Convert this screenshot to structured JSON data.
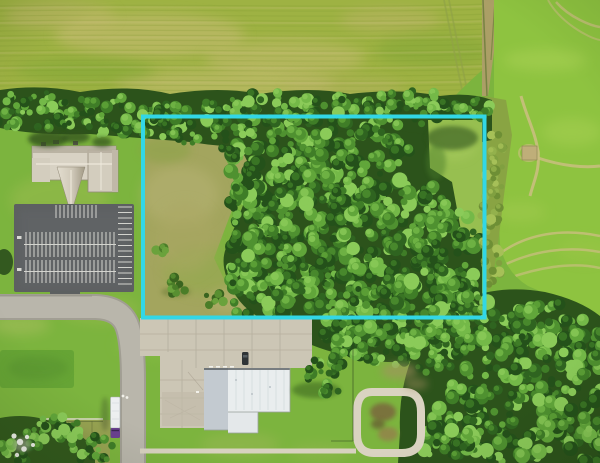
{
  "photo": {
    "type": "aerial-drone-photograph",
    "alt": "Aerial view of a wooded vacant land parcel outlined with a cyan boundary, next to a church with parking lot, crop fields, a street intersection, a white metal-roof building, a loop driveway and a semi truck",
    "width_px": 600,
    "height_px": 463
  },
  "boundary_overlay": {
    "shape": "rectangle",
    "color": "#32d7e6",
    "x": 143,
    "y": 116.5,
    "width": 341.5,
    "height": 201,
    "stroke_width": 4
  },
  "palette": {
    "crop_field_yellow_green": "#9eb243",
    "crop_field_bright_green": "#8ec340",
    "tractor_track_tan": "#cdbe83",
    "woods_dark_green": "#2c531b",
    "woods_light_green": "#74b948",
    "meadow_olive": "#a3a55e",
    "lawn_green": "#7cb43e",
    "asphalt_gray": "#5d6061",
    "street_gray": "#b9b6ab",
    "concrete_tan": "#ccc6b5",
    "metal_roof_white": "#e9edee",
    "church_roof_tan": "#d8d2c4",
    "truck_cab_purple": "#6a4190"
  },
  "visible_features": [
    "cyan rectangular property boundary overlay",
    "dense wooded parcel inside boundary",
    "open olive meadow inside west part of boundary",
    "grass clearing inside northeast corner of boundary",
    "hedgerow tree line along north field edge",
    "yellow-green crop field top left",
    "bright green crop field with curved tractor tracks on right",
    "small tan shed in right field",
    "church building with pyramidal steeple",
    "asphalt parking lot with white stalls",
    "street intersection with curve",
    "semi truck with white trailer and purple cab",
    "scored concrete pad",
    "white metal roof commercial building",
    "parked dark car",
    "loop driveway with brush in center",
    "fenced scrub yard bottom left",
    "trees in bottom right corner"
  ]
}
